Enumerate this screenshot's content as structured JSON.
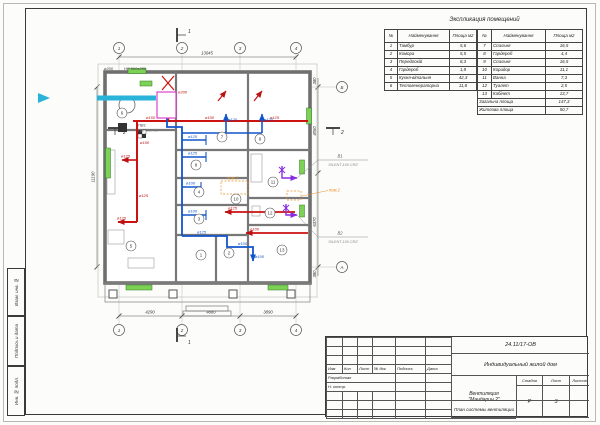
{
  "sheet": {
    "side_stamps": [
      "Взам. инв. №",
      "Подпись и дата",
      "Инв. № подл."
    ]
  },
  "schedule": {
    "title": "Экспликация помещений",
    "headers": {
      "num": "№",
      "name": "Найменування",
      "area": "Площа м2"
    },
    "left_rows": [
      {
        "num": "1",
        "name": "Тамбур",
        "area": "5,6"
      },
      {
        "num": "2",
        "name": "Комора",
        "area": "5,5"
      },
      {
        "num": "3",
        "name": "Передпокій",
        "area": "8,3"
      },
      {
        "num": "4",
        "name": "Гардероб",
        "area": "1,8"
      },
      {
        "num": "5",
        "name": "Кухня-вітальня",
        "area": "42,3"
      },
      {
        "num": "6",
        "name": "Теплогенераторна",
        "area": "11,8"
      }
    ],
    "right_rows": [
      {
        "num": "7",
        "name": "Спальня",
        "area": "16,5"
      },
      {
        "num": "8",
        "name": "Гардероб",
        "area": "4,4"
      },
      {
        "num": "9",
        "name": "Спальня",
        "area": "16,5"
      },
      {
        "num": "10",
        "name": "Коридор",
        "area": "11,1"
      },
      {
        "num": "11",
        "name": "Ванна",
        "area": "7,3"
      },
      {
        "num": "12",
        "name": "Туалет",
        "area": "2,5"
      },
      {
        "num": "13",
        "name": "Кабінет",
        "area": "13,7"
      }
    ],
    "totals": [
      {
        "label": "Загальна площа",
        "value": "147,3"
      },
      {
        "label": "Житлова площа",
        "value": "50,7"
      }
    ]
  },
  "title_block": {
    "doc_number": "24.11/17-ОВ",
    "object_name": "Индивидуальный жилой дом",
    "project_name_1": "Вентиляция",
    "project_name_2": "\"Мандарин 2\"",
    "drawing_title": "План системы вентиляции",
    "stage_label": "Стадия",
    "sheet_label": "Лист",
    "sheets_label": "Листов",
    "stage_value": "Р",
    "sheet_value": "3",
    "header_cells": [
      "Изм",
      "Кол",
      "Лист",
      "№ док",
      "Подпись",
      "Дата"
    ],
    "row_labels": [
      "Разработал",
      "Н. контр."
    ]
  },
  "plan": {
    "axis_cols": [
      "1",
      "2",
      "3",
      "4"
    ],
    "axis_row_top": "Б",
    "axis_row_bottom": "А",
    "dim_bottom": [
      "4290",
      "4880",
      "3890"
    ],
    "dim_top_overall": "13045",
    "dim_left_overall": "11190",
    "dim_right": [
      "380",
      "4060",
      "6370",
      "380"
    ],
    "room_numbers": [
      "1",
      "2",
      "3",
      "4",
      "5",
      "6",
      "7",
      "8",
      "9",
      "10",
      "11",
      "12",
      "13"
    ],
    "labels": {
      "d100": "ø100",
      "d125": "ø125",
      "d150": "ø150",
      "d200": "ø200",
      "main_duct": "НР 500x250",
      "ahu_tag": "ПВ1",
      "ahu_model": "ПВУ-450-ЕС",
      "fan1_tag": "В1",
      "fan1_model": "SILENT-100 CRZ",
      "fan2_tag": "В2",
      "fan2_model": "SILENT-100 CRZ",
      "pom2": "пом.2",
      "pom3": "пом.3",
      "section1": "1",
      "section2": "2"
    }
  }
}
